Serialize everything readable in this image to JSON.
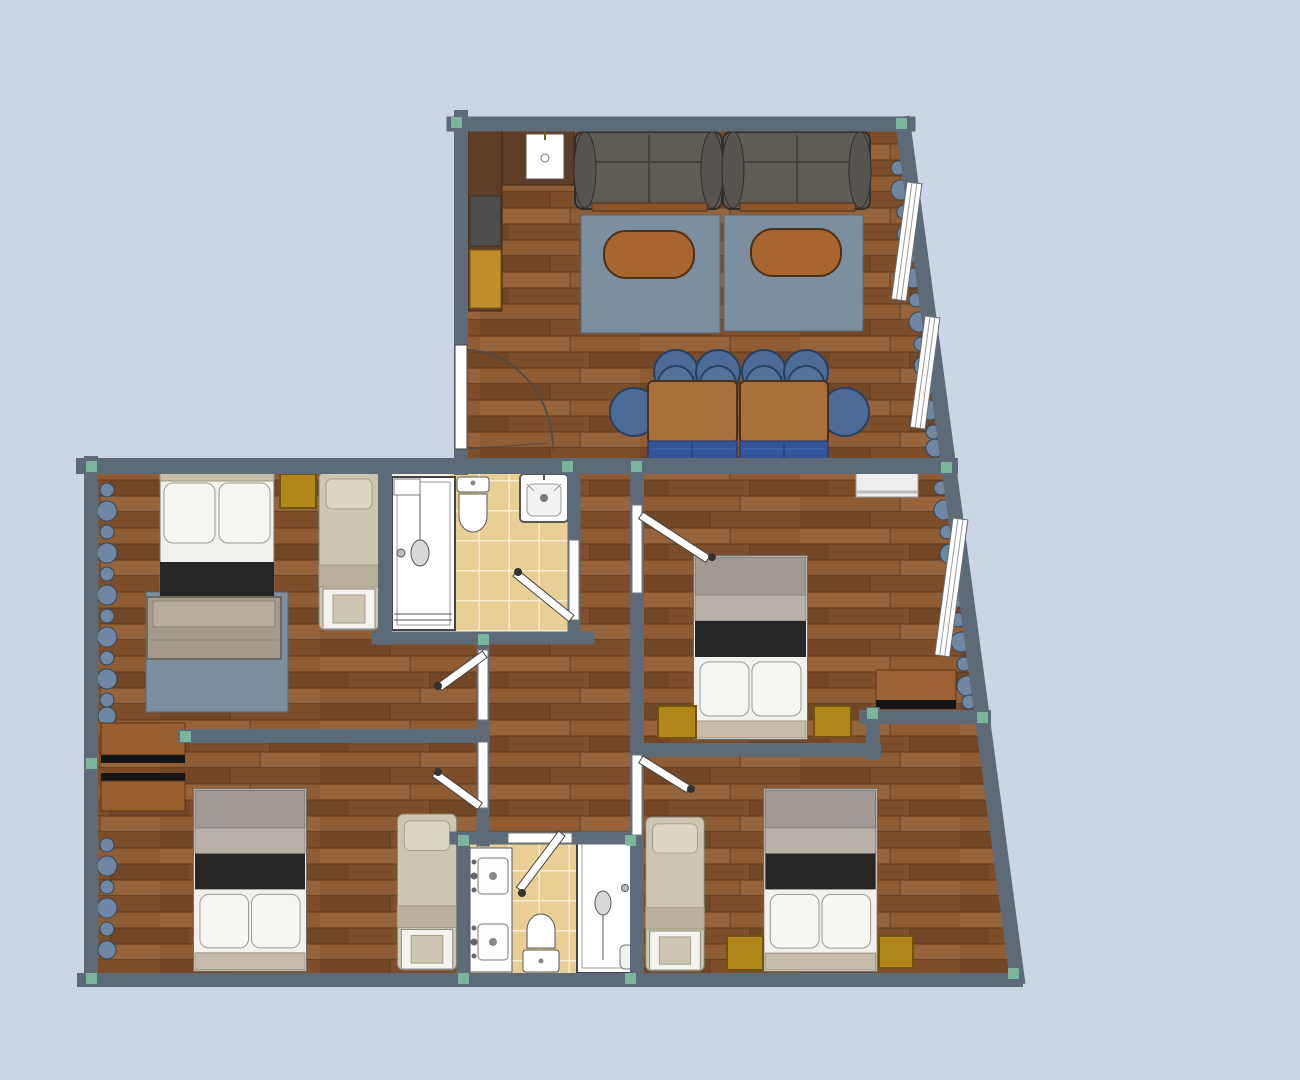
{
  "canvas": {
    "width": 1300,
    "height": 1080,
    "background": "#cbd5e6"
  },
  "palette": {
    "bg": "#cbd5e6",
    "wall": "#5d6a78",
    "wallNode": "#7fc2a2",
    "woodA": "#7d4e29",
    "woodB": "#8f5c33",
    "woodC": "#734626",
    "woodD": "#96633a",
    "woodSeam": "#54331b",
    "tileFill": "#e9cf96",
    "tileGrout": "#f8eed6",
    "bathBase": "#f6efdc",
    "rug": "#7b8fa0",
    "rugBorder": "#55687a",
    "sofa": "#5f5b55",
    "sofaBorder": "#312f2b",
    "sofaRail": "#8c5429",
    "coffeeTable": "#a9652f",
    "coffeeTableBorder": "#4f3117",
    "diningTable": "#a8703d",
    "diningTableBorder": "#4a3018",
    "chairBlue": "#4c6b98",
    "chairBorder": "#27415f",
    "benchBlue": "#31549b",
    "benchBlueBorder": "#1d3464",
    "counter": "#5e3c25",
    "counterBorder": "#3e2715",
    "cabinetYellow": "#bf8d2a",
    "appliance": "#4f4d4b",
    "fixtureWhite": "#ffffff",
    "fixtureStroke": "#555555",
    "bedFrame": "#efeeea",
    "bedGrayTop": "#a09a92",
    "bedGrayMid": "#b7b1a9",
    "bedBlack": "#262626",
    "bedWhite": "#f2f1ee",
    "pillow": "#f7f6f3",
    "pillowStroke": "#9a9a94",
    "bedFooter": "#c5bcaa",
    "singleBed": "#cdc7b2",
    "singleBedFold": "#b9b19b",
    "singleBedStroke": "#84806f",
    "benchTan": "#a49b8d",
    "nightstand": "#b1861b",
    "nightstandBorder": "#6e5410",
    "dresser": "#9a5f30",
    "dresserBlack": "#151515",
    "desk": "#9c6134",
    "deskBorder": "#5a3417",
    "curtain": "#6f87a2",
    "curtainStroke": "#31465c",
    "windowWhite": "#ffffff",
    "windowStroke": "#6a6a6a",
    "doorWhite": "#ffffff",
    "doorStroke": "#444444"
  },
  "inventory": {
    "living_room": [
      "kitchen-counter",
      "kitchen-sink",
      "stove",
      "kitchen-cabinet",
      "sofa",
      "sofa",
      "rug",
      "rug",
      "coffee-table",
      "coffee-table",
      "dining-table",
      "dining-table",
      "dining-chair x6",
      "dining-bench x2",
      "window x2",
      "curtain",
      "entrance-door"
    ],
    "bedroom_middle_left": [
      "double-bed",
      "bed-bench",
      "rug",
      "nightstand",
      "single-bed",
      "window x2",
      "curtain x2"
    ],
    "bathroom_top": [
      "shower",
      "toilet",
      "sink",
      "door"
    ],
    "bedroom_middle_right": [
      "double-bed",
      "nightstand x2",
      "shelf-unit",
      "desk",
      "window",
      "curtain",
      "door"
    ],
    "bedroom_bottom_left": [
      "double-bed",
      "single-bed",
      "wardrobe x2",
      "window",
      "curtain",
      "door"
    ],
    "bathroom_bottom": [
      "double-sink",
      "toilet",
      "shower",
      "door"
    ],
    "bedroom_bottom_right": [
      "double-bed",
      "single-bed",
      "nightstand x2",
      "door"
    ]
  }
}
